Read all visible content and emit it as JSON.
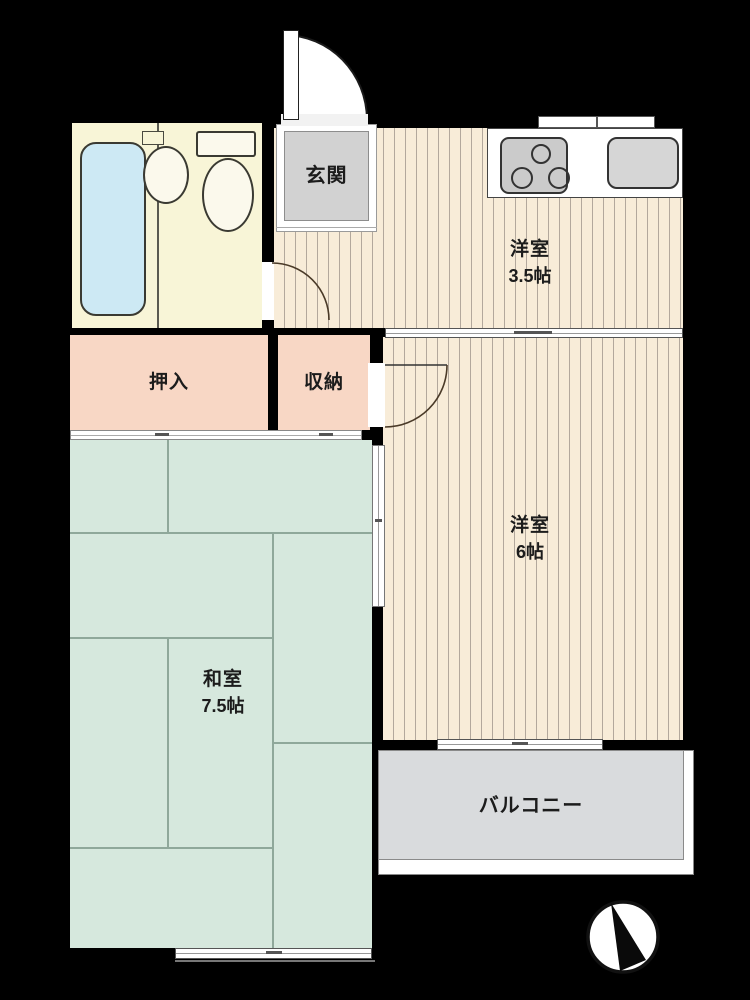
{
  "title": "apartment-floor-plan",
  "rooms": {
    "genkan": {
      "label": "玄関"
    },
    "western_room_small": {
      "name": "洋室",
      "size": "3.5帖"
    },
    "oshiire": {
      "label": "押入"
    },
    "storage": {
      "label": "収納"
    },
    "japanese_room": {
      "name": "和室",
      "size": "7.5帖"
    },
    "western_room_large": {
      "name": "洋室",
      "size": "6帖"
    },
    "balcony": {
      "label": "バルコニー"
    }
  },
  "fixtures": {
    "bathtub": "bathtub-icon",
    "sink": "washbasin-icon",
    "toilet": "toilet-icon",
    "stove": "stove-icon",
    "kitchen_sink": "kitchen-sink-icon",
    "compass": "compass-north-icon"
  },
  "colors": {
    "wall": "#000000",
    "flooring": "#f8ecd8",
    "tatami": "#d6e8dd",
    "closet": "#f8d7c5",
    "genkan": "#d2d2d2",
    "balcony": "#d9dbdd",
    "bathroom": "#f8f5d7",
    "bathtub": "#cde9f4"
  }
}
